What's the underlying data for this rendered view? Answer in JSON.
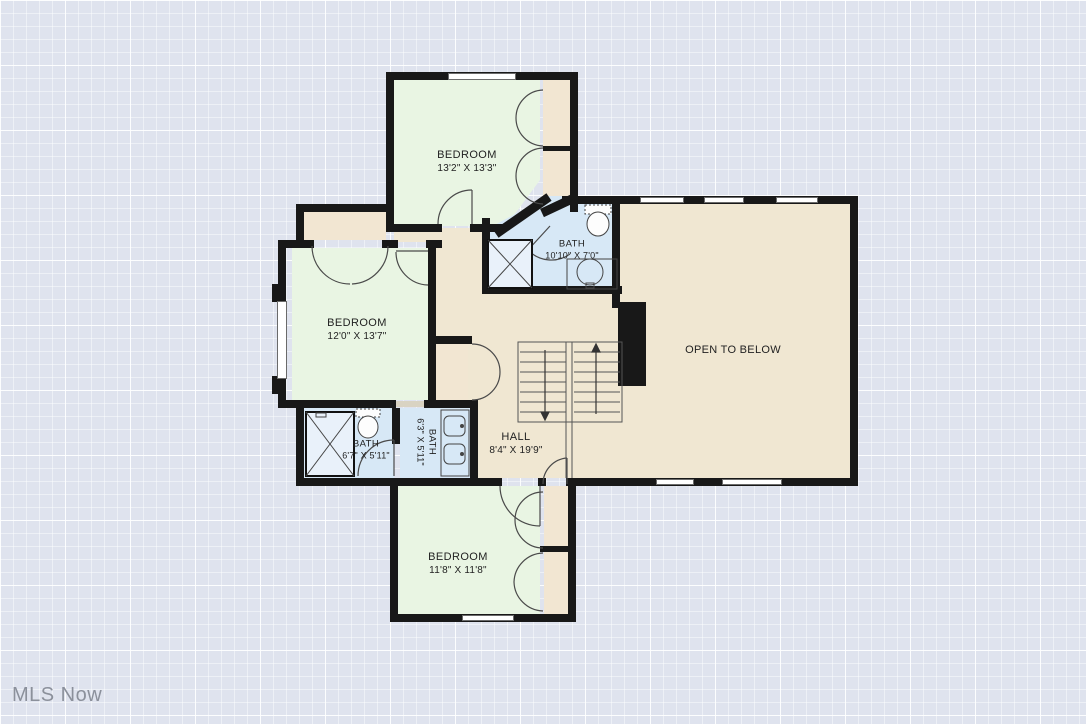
{
  "watermark": "MLS Now",
  "rooms": {
    "bedroom_top": {
      "name": "BEDROOM",
      "dims": "13'2\" X 13'3\""
    },
    "bedroom_left": {
      "name": "BEDROOM",
      "dims": "12'0\" X 13'7\""
    },
    "bedroom_bottom": {
      "name": "BEDROOM",
      "dims": "11'8\" X 11'8\""
    },
    "bath_top": {
      "name": "BATH",
      "dims": "10'10\" X 7'0\""
    },
    "bath_left": {
      "name": "BATH",
      "dims": "6'7\" X 5'11\""
    },
    "bath_middle": {
      "name": "BATH",
      "dims": "6'3\" X 5'11\""
    },
    "hall": {
      "name": "HALL",
      "dims": "8'4\" X 19'9\""
    },
    "open_to_below": {
      "name": "OPEN TO BELOW"
    }
  },
  "colors": {
    "background": "#dfe3ee",
    "wall": "#181818",
    "bedroom": "#e9f5e3",
    "bath": "#d7e8f6",
    "hall": "#f0e7d2",
    "closet": "#f2e6d2",
    "shower": "#e9f1fa"
  }
}
